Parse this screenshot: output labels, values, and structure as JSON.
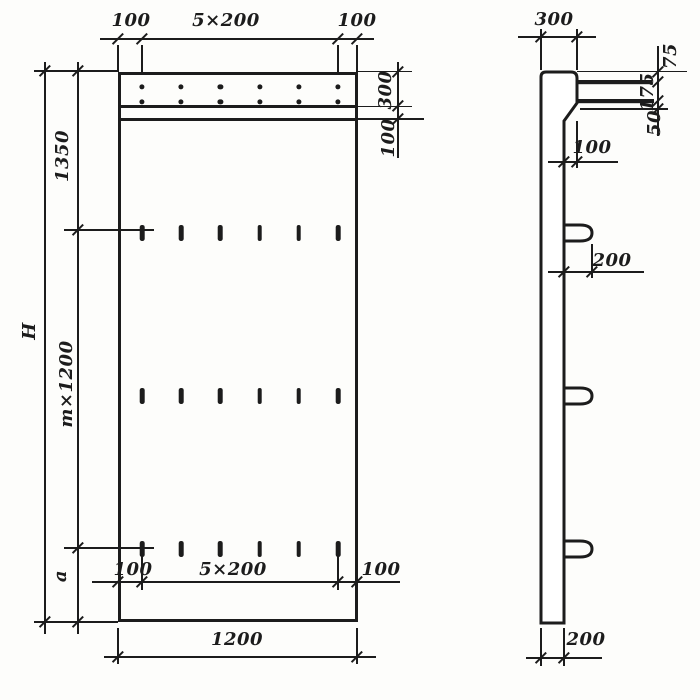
{
  "colors": {
    "ink": "#1c1c1c",
    "paper": "#fdfdfb"
  },
  "front_view": {
    "view_name": "panel-front-elevation",
    "top_dimensions": {
      "left_margin": "100",
      "spacing": "5×200",
      "right_margin": "100"
    },
    "right_dimensions": {
      "top_band": "300",
      "strip": "100"
    },
    "left_dimensions": {
      "overall_height": "H",
      "top_offset": "1350",
      "module_spacing": "m×1200",
      "bottom_offset": "a"
    },
    "bottom_inner_dimensions": {
      "left_margin": "100",
      "spacing": "5×200",
      "right_margin": "100"
    },
    "overall_width": "1200",
    "holes": {
      "rows": 2,
      "columns": 6
    },
    "slots": {
      "rows": 3,
      "columns": 6
    }
  },
  "side_view": {
    "view_name": "panel-side-section",
    "top_thickness": "300",
    "right_dimensions": {
      "top_to_bar1": "75",
      "bar1_to_bar2": "175",
      "bar2_to_band": "50"
    },
    "step": "100",
    "loop_projection": "200",
    "bottom_thickness": "200",
    "bars": 2,
    "loops": 3
  }
}
